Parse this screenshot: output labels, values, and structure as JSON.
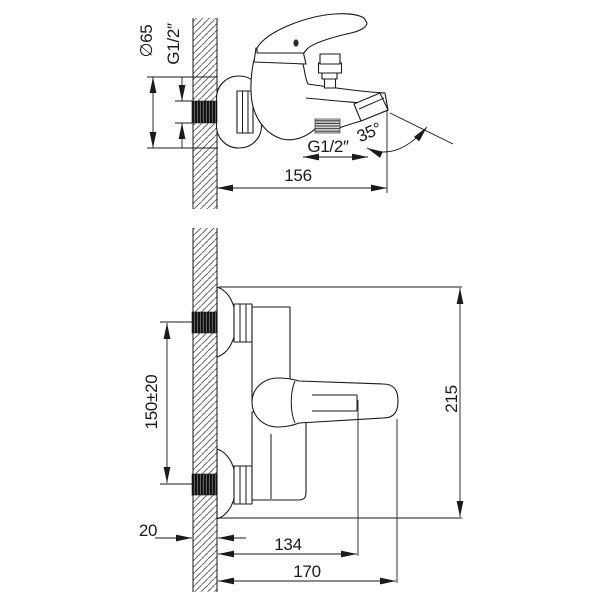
{
  "drawing": {
    "side_view": {
      "labels": {
        "diameter": "∅65",
        "wall_thread": "G1/2″",
        "spout_thread": "G1/2″",
        "spout_angle": "35°",
        "projection": "156"
      }
    },
    "front_view": {
      "labels": {
        "connection_spacing": "150±20",
        "overall_height": "215",
        "wall_thickness": "20",
        "spout_reach": "134",
        "overall_reach": "170"
      }
    },
    "colors": {
      "background": "#ffffff",
      "line": "#1a1a1a"
    }
  }
}
